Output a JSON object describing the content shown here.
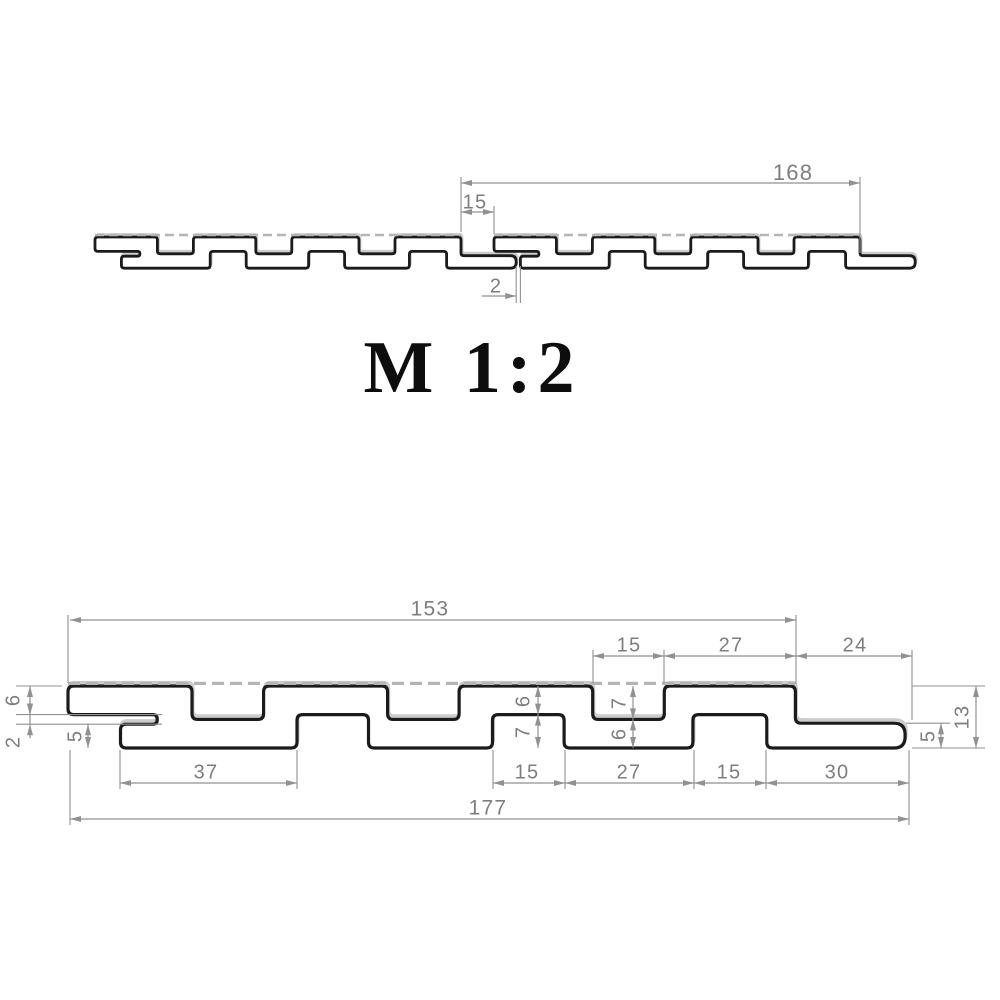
{
  "colors": {
    "background": "#ffffff",
    "profile": "#1b1b1b",
    "profile_fill": "#ffffff",
    "profile_shadow": "#cccccc",
    "dashed_line": "#b5b5b5",
    "dim_line": "#919191",
    "dim_text": "#7e7e7e",
    "scale_text": "#0d0d0d"
  },
  "scale_label": {
    "text": "M 1:2",
    "x": 472,
    "y": 392,
    "font_size": 74,
    "letter_spacing": 6
  },
  "profile_mm": {
    "length": 177,
    "thickness": 13,
    "corner_radius": 1.2,
    "back_face_span": [
      0,
      152.5
    ],
    "outline": [
      [
        0,
        0
      ],
      [
        26,
        0
      ],
      [
        26,
        7
      ],
      [
        41,
        7
      ],
      [
        41,
        0
      ],
      [
        67,
        0
      ],
      [
        67,
        7
      ],
      [
        82,
        7
      ],
      [
        82,
        0
      ],
      [
        110,
        0
      ],
      [
        110,
        7
      ],
      [
        125,
        7
      ],
      [
        125,
        0
      ],
      [
        152.5,
        0
      ],
      [
        152.5,
        7.8
      ],
      [
        175.5,
        7.8,
        2.4
      ],
      [
        175.5,
        13,
        2.4
      ],
      [
        146.5,
        13
      ],
      [
        146.5,
        6
      ],
      [
        131,
        6
      ],
      [
        131,
        13
      ],
      [
        104,
        13
      ],
      [
        104,
        6
      ],
      [
        89,
        6
      ],
      [
        89,
        13
      ],
      [
        63,
        13
      ],
      [
        63,
        6
      ],
      [
        48,
        6
      ],
      [
        48,
        13
      ],
      [
        11,
        13
      ],
      [
        11,
        8
      ],
      [
        18.7,
        8
      ],
      [
        18.7,
        6
      ],
      [
        0,
        6
      ]
    ]
  },
  "views": {
    "top": {
      "name": "joined-panels-view",
      "scale": 2.4,
      "stroke_width": 2.8,
      "dash_width": 2.4,
      "dash_array": "9 5",
      "dash_offset": 2,
      "shadow_dx": 1,
      "shadow_dy": -2.5,
      "panels": [
        {
          "ox": 95,
          "oy": 237
        },
        {
          "ox": 494,
          "oy": 237
        }
      ],
      "dims_h": [
        {
          "label": "168",
          "x1": 461,
          "x2": 860,
          "y": 183,
          "tx": 793,
          "ty": 174,
          "fs": 22
        },
        {
          "label": "15",
          "x1": 461,
          "x2": 494,
          "y": 212,
          "tx": 475,
          "ty": 203,
          "fs": 20
        }
      ],
      "dims_v": [],
      "ext": [
        [
          461,
          177,
          461,
          232
        ],
        [
          860,
          177,
          860,
          253
        ],
        [
          494,
          206,
          494,
          234
        ],
        [
          516.2,
          266,
          516.2,
          303
        ],
        [
          520.4,
          266,
          520.4,
          303
        ]
      ],
      "gap_dim": {
        "label": "2",
        "line": [
          482,
          296,
          516.2,
          296
        ],
        "tx": 496,
        "ty": 287,
        "fs": 20
      }
    },
    "bottom": {
      "name": "single-panel-view",
      "scale": 4.77,
      "stroke_width": 3.2,
      "dash_width": 3.2,
      "dash_array": "12 6",
      "dash_offset": 2.6,
      "shadow_dx": 1,
      "shadow_dy": -3.5,
      "panels": [
        {
          "ox": 68,
          "oy": 686
        }
      ],
      "dims_h": [
        {
          "label": "153",
          "x1": 70,
          "x2": 796,
          "y": 620,
          "tx": 430,
          "ty": 610,
          "fs": 21
        },
        {
          "label": "15",
          "x1": 593,
          "x2": 664,
          "y": 656,
          "tx": 629,
          "ty": 646,
          "fs": 20
        },
        {
          "label": "27",
          "x1": 664,
          "x2": 796,
          "y": 656,
          "tx": 731,
          "ty": 646,
          "fs": 20
        },
        {
          "label": "24",
          "x1": 796,
          "x2": 912,
          "y": 656,
          "tx": 855,
          "ty": 646,
          "fs": 20
        },
        {
          "label": "37",
          "x1": 120,
          "x2": 297,
          "y": 783,
          "tx": 206,
          "ty": 773,
          "fs": 20
        },
        {
          "label": "15",
          "x1": 493,
          "x2": 565,
          "y": 783,
          "tx": 527,
          "ty": 773,
          "fs": 20
        },
        {
          "label": "27",
          "x1": 565,
          "x2": 694,
          "y": 783,
          "tx": 629,
          "ty": 773,
          "fs": 20
        },
        {
          "label": "15",
          "x1": 694,
          "x2": 766,
          "y": 783,
          "tx": 729,
          "ty": 773,
          "fs": 20
        },
        {
          "label": "30",
          "x1": 766,
          "x2": 909,
          "y": 783,
          "tx": 837,
          "ty": 773,
          "fs": 20
        },
        {
          "label": "177",
          "x1": 70,
          "x2": 909,
          "y": 819,
          "tx": 488,
          "ty": 809,
          "fs": 21
        }
      ],
      "dims_v": [
        {
          "label": "6",
          "x": 538,
          "y1": 686,
          "y2": 714.6,
          "tx": 524,
          "ty": 701,
          "fs": 20
        },
        {
          "label": "7",
          "x": 538,
          "y1": 714.6,
          "y2": 748,
          "tx": 524,
          "ty": 732,
          "fs": 20
        },
        {
          "label": "7",
          "x": 633,
          "y1": 686,
          "y2": 719.4,
          "tx": 620,
          "ty": 703,
          "fs": 20
        },
        {
          "label": "6",
          "x": 633,
          "y1": 719.4,
          "y2": 748,
          "tx": 620,
          "ty": 734,
          "fs": 20
        },
        {
          "label": "6",
          "x": 30,
          "y1": 686,
          "y2": 714.6,
          "tx": 14,
          "ty": 700,
          "fs": 20
        },
        {
          "label": "2",
          "x": 30,
          "y1": 714.6,
          "y2": 724.2,
          "tx": 14,
          "ty": 742,
          "fs": 20,
          "outside": true
        },
        {
          "label": "5",
          "x": 88,
          "y1": 724.2,
          "y2": 748,
          "tx": 76,
          "ty": 736,
          "fs": 20
        },
        {
          "label": "5",
          "x": 941,
          "y1": 723.2,
          "y2": 748,
          "tx": 929,
          "ty": 736,
          "fs": 20
        },
        {
          "label": "13",
          "x": 976,
          "y1": 686,
          "y2": 748,
          "tx": 963,
          "ty": 717,
          "fs": 20
        }
      ],
      "ext": [
        [
          68,
          615,
          68,
          683
        ],
        [
          796,
          615,
          796,
          684
        ],
        [
          593,
          650,
          593,
          683
        ],
        [
          664,
          650,
          664,
          683
        ],
        [
          912,
          650,
          912,
          720
        ],
        [
          16,
          686,
          62,
          686
        ],
        [
          16,
          714.6,
          162,
          714.6
        ],
        [
          16,
          724.2,
          162,
          724.2
        ],
        [
          120,
          750,
          120,
          789
        ],
        [
          297,
          750,
          297,
          789
        ],
        [
          493,
          750,
          493,
          789
        ],
        [
          565,
          750,
          565,
          789
        ],
        [
          694,
          750,
          694,
          789
        ],
        [
          766,
          750,
          766,
          789
        ],
        [
          70,
          750,
          70,
          825
        ],
        [
          909,
          750,
          909,
          825
        ],
        [
          906,
          723.2,
          950,
          723.2
        ],
        [
          912,
          686,
          985,
          686
        ],
        [
          912,
          748,
          985,
          748
        ]
      ]
    }
  }
}
